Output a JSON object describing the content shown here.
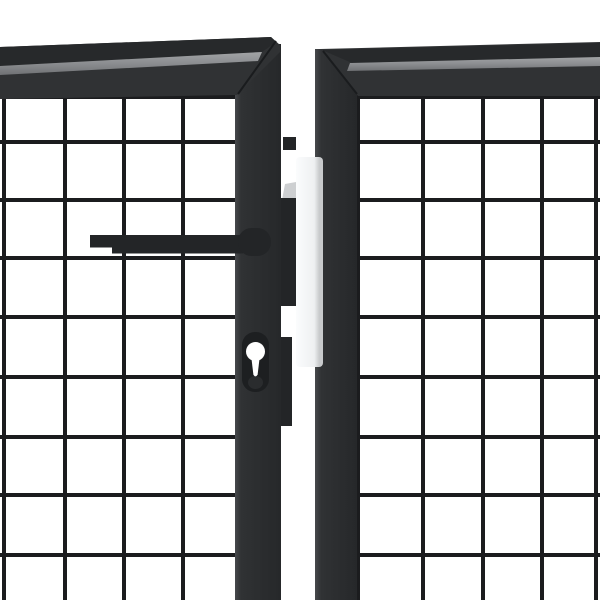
{
  "meta": {
    "alt": "Close-up product photo of an anthracite grey steel mesh garden double gate showing the lever handle, euro-profile lock cylinder keyhole and white latch plate between the two gate leaves"
  },
  "colors": {
    "background": "#ffffff",
    "frame_face": "#303234",
    "frame_band": "#27292b",
    "frame_seam": "#1a1c1e",
    "frame_edge_light": "#47494c",
    "frame_deep": "#26282a",
    "stripe_light": "#a2a4a6",
    "stripe_mid": "#8b8d90",
    "stripe_dark": "#6f7174",
    "wire": "#1b1c1e",
    "handle": "#232527",
    "escutcheon": "#1d1f21",
    "cylinder_shadow": "#2a2c2e",
    "keyhole": "#ffffff",
    "latch": "#232527",
    "latch_wedge": "#cdcfd1",
    "plate_white": "#fbfcfd",
    "plate_mid": "#eef0f1",
    "plate_shade": "#c8cacc"
  },
  "mesh": {
    "wire_px": 4,
    "left": {
      "vertical_x": [
        4,
        65,
        124,
        183
      ],
      "v_y1": 88,
      "v_y2": 600,
      "horizontal_y": [
        97,
        142,
        200,
        258,
        317,
        377,
        437,
        495,
        555
      ],
      "h_x1": -2,
      "h_x2": 239
    },
    "right": {
      "vertical_x": [
        358,
        423,
        483,
        542,
        596
      ],
      "v_y1": 90,
      "v_y2": 600,
      "horizontal_y": [
        97,
        142,
        200,
        258,
        317,
        377,
        437,
        495,
        555
      ],
      "h_x1": 352,
      "h_x2": 602
    }
  }
}
